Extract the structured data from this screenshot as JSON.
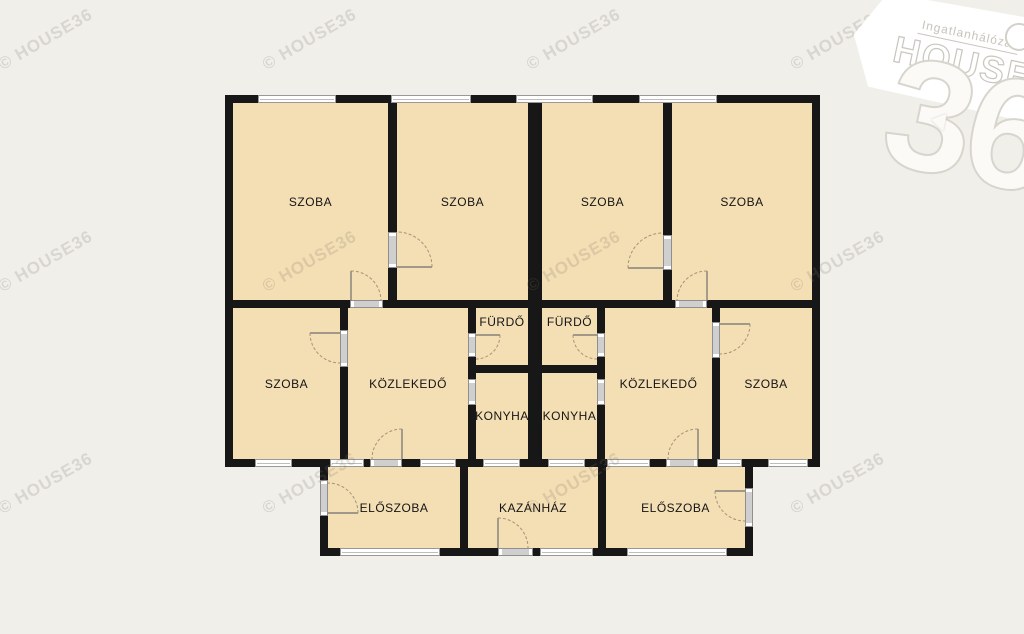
{
  "colors": {
    "background": "#f1efea",
    "room_fill": "#f4deb4",
    "wall": "#171717",
    "window": "#ffffff",
    "door_swing": "#a5947a"
  },
  "watermark": {
    "text": "© HOUSE36"
  },
  "logo": {
    "network": "Ingatlanhálózat",
    "brand": "HOUSE",
    "number": "36"
  },
  "rooms": {
    "szoba_top_1": {
      "label": "SZOBA"
    },
    "szoba_top_2": {
      "label": "SZOBA"
    },
    "szoba_top_3": {
      "label": "SZOBA"
    },
    "szoba_top_4": {
      "label": "SZOBA"
    },
    "szoba_mid_left": {
      "label": "SZOBA"
    },
    "kozlekedo_left": {
      "label": "KÖZLEKEDŐ"
    },
    "furdo_left": {
      "label": "FÜRDŐ"
    },
    "konyha_left": {
      "label": "KONYHA"
    },
    "furdo_right": {
      "label": "FÜRDŐ"
    },
    "konyha_right": {
      "label": "KONYHA"
    },
    "kozlekedo_right": {
      "label": "KÖZLEKEDŐ"
    },
    "szoba_mid_right": {
      "label": "SZOBA"
    },
    "eloszoba_left": {
      "label": "ELŐSZOBA"
    },
    "kazanhaz": {
      "label": "KAZÁNHÁZ"
    },
    "eloszoba_right": {
      "label": "ELŐSZOBA"
    }
  }
}
